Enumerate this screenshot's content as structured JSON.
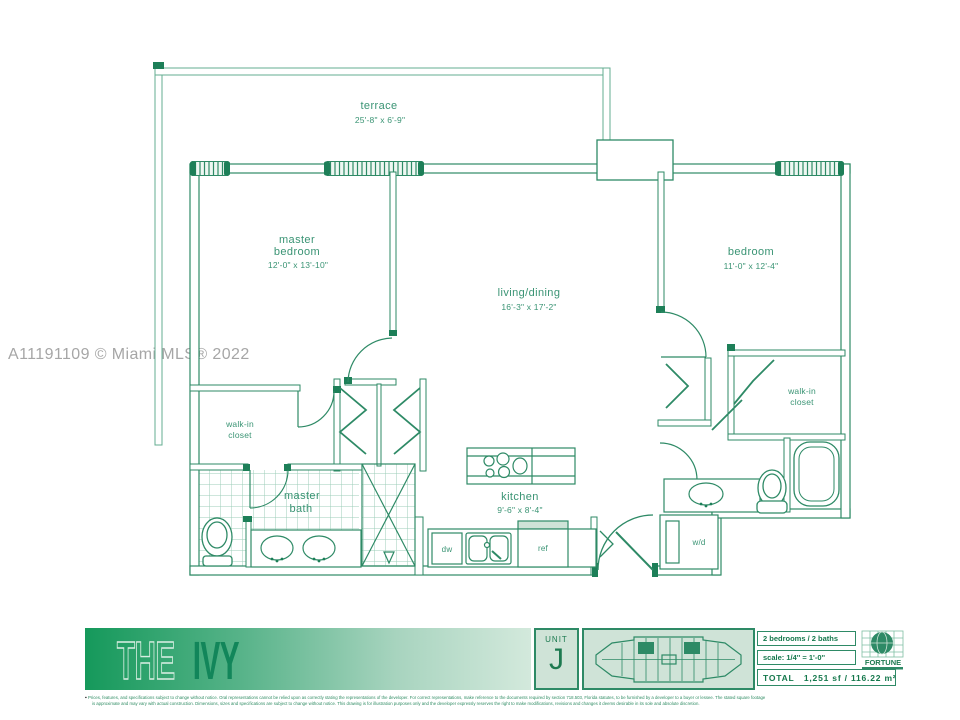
{
  "watermark": "A11191109 © Miami MLS® 2022",
  "plan": {
    "terrace": {
      "name": "terrace",
      "dims": "25'-8\" x 6'-9\""
    },
    "master_bedroom": {
      "line1": "master",
      "line2": "bedroom",
      "dims": "12'-0\" x 13'-10\""
    },
    "living_dining": {
      "name": "living/dining",
      "dims": "16'-3\" x 17'-2\""
    },
    "bedroom": {
      "name": "bedroom",
      "dims": "11'-0\" x 12'-4\""
    },
    "kitchen": {
      "name": "kitchen",
      "dims": "9'-6\" x 8'-4\""
    },
    "master_bath": {
      "line1": "master",
      "line2": "bath"
    },
    "walkin_left": {
      "line1": "walk-in",
      "line2": "closet"
    },
    "walkin_right": {
      "line1": "walk-in",
      "line2": "closet"
    },
    "appliances": {
      "dishwasher": "dw",
      "refrigerator": "ref",
      "washer_dryer": "w/d"
    }
  },
  "footer": {
    "logo_the": "THE",
    "logo_ivy": "IVY",
    "unit_label": "UNIT",
    "unit_letter": "J",
    "beds_baths": "2 bedrooms / 2 baths",
    "scale": "scale: 1/4'' = 1'-0''",
    "total": "TOTAL   1,251 sf / 116.22 m²",
    "brand": "FORTUNE",
    "disclaimer_line1": "Prices, features, and specifications subject to change without notice. Oral representations cannot be relied upon as correctly stating the representations of the developer. For correct representations, make reference to the documents required by section 718.503, Florida statutes, to be furnished by a developer to a buyer or lessee. The stated square footage",
    "disclaimer_line2": "is approximate and may vary with actual construction. Dimensions, sizes and specifications are subject to change without notice. This drawing is for illustration purposes only and the developer expressly reserves the right to make modifications, revisions and changes it deems desirable in its sole and absolute discretion."
  },
  "colors": {
    "plan_line": "#2e8a66",
    "plan_dark": "#1d7f58",
    "plan_text": "#3a9474",
    "light_green_bg": "#cfe3d7",
    "gradient_start": "#15995b",
    "gradient_end": "#d3e9dc",
    "watermark_gray": "#a6a6a6"
  }
}
